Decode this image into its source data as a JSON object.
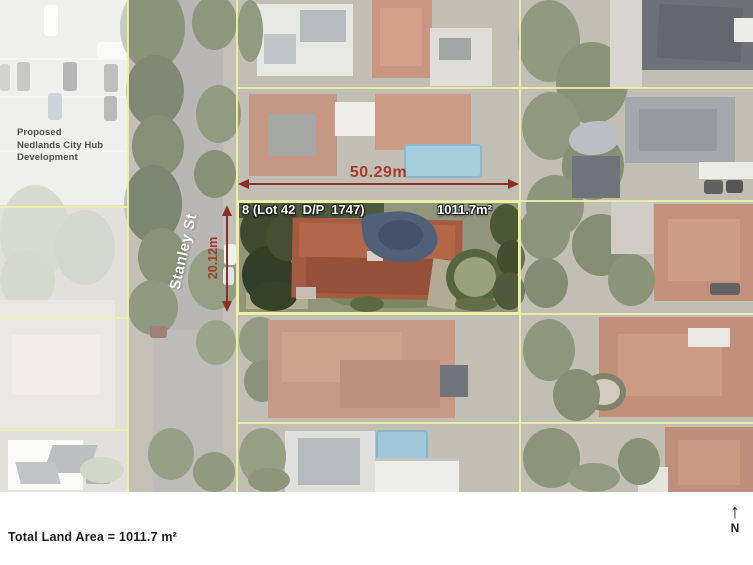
{
  "annotations": {
    "development_note": "Proposed\nNedlands City Hub\nDevelopment",
    "street_name": "Stanley St",
    "lot_label": "8 (Lot 42  D/P  1747)",
    "lot_area": "1011.7m²",
    "width_dim": "50.29m",
    "depth_dim": "20.12m"
  },
  "footer": {
    "total_area": "Total Land Area = 1011.7 m²",
    "north_arrow": "↑",
    "north_label": "N"
  },
  "colors": {
    "dimension_red": "#a93a2e",
    "dimension_red_dark": "#8d2f26",
    "boundary_yellow": "#edf1a4",
    "label_white": "#ffffff",
    "note_gray": "#4e4e4c",
    "footer_text": "#1b1b1b",
    "north_black": "#222222"
  }
}
